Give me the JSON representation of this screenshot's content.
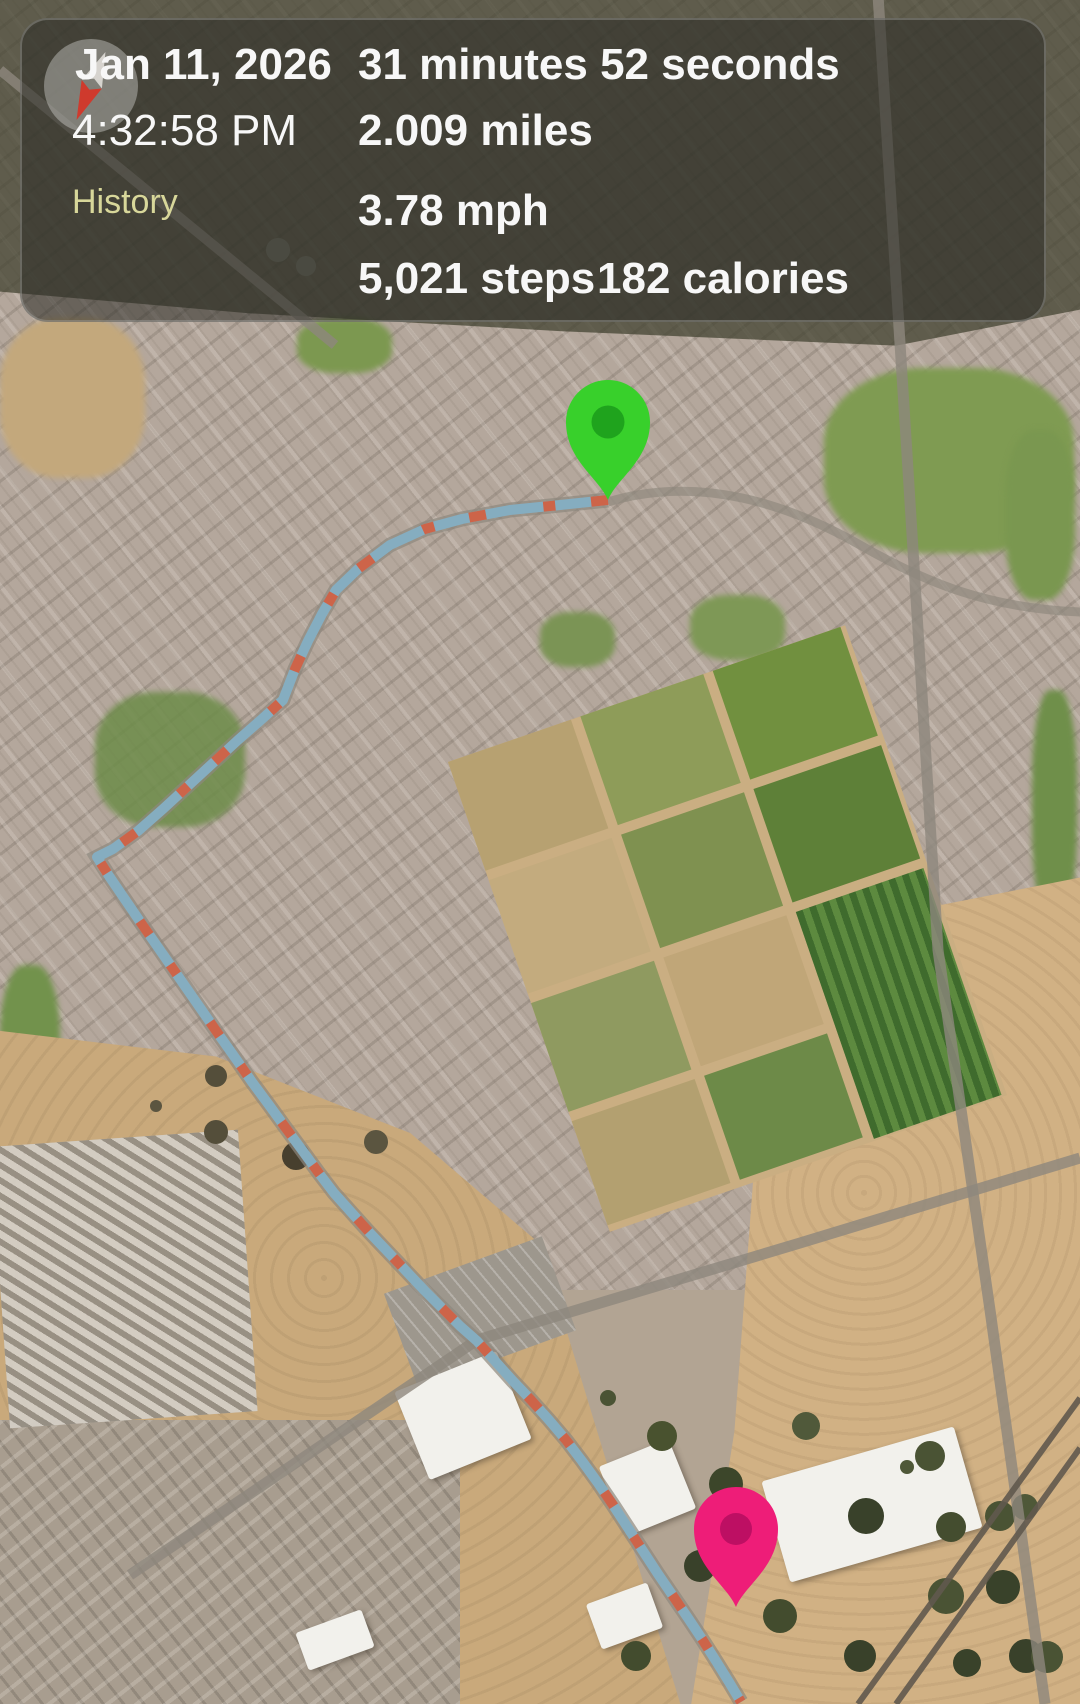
{
  "panel": {
    "date": "Jan 11, 2026",
    "time": "4:32:58 PM",
    "history_label": "History",
    "duration": "31 minutes 52 seconds",
    "distance": "2.009 miles",
    "speed": "3.78 mph",
    "steps": "5,021 steps",
    "calories": "182 calories",
    "history_label_color": "#d8d79a",
    "text_color": "#f7f7f7"
  },
  "map": {
    "view": "satellite",
    "route": {
      "points": "608,500 560,505 510,510 462,519 425,529 390,545 358,569 336,590 322,614 308,641 295,669 283,700 262,719 238,740 213,763 188,786 163,809 138,831 113,849 97,857 109,876 124,898 139,920 155,943 171,966 187,989 203,1012 219,1035 236,1059 252,1082 269,1105 285,1127 302,1150 318,1172 334,1193 351,1212 369,1232 388,1252 407,1272 425,1291 443,1309 460,1326 477,1341 495,1361 513,1381 531,1400 549,1420 566,1440 582,1461 598,1483 613,1505 628,1528 643,1551 658,1574 673,1596 688,1618 702,1639 716,1661 729,1682 741,1702",
      "line_color": "#85adc0",
      "dash_color": "#cd6449"
    },
    "start_pin": {
      "transform": "translate(608,500)",
      "color": "#38d02b",
      "inner_color": "#1fa31d"
    },
    "end_pin": {
      "transform": "translate(736,1607)",
      "color": "#ee1d78",
      "inner_color": "#bd0f63"
    }
  },
  "compass": {
    "needle_color": "#cf3a2d"
  }
}
